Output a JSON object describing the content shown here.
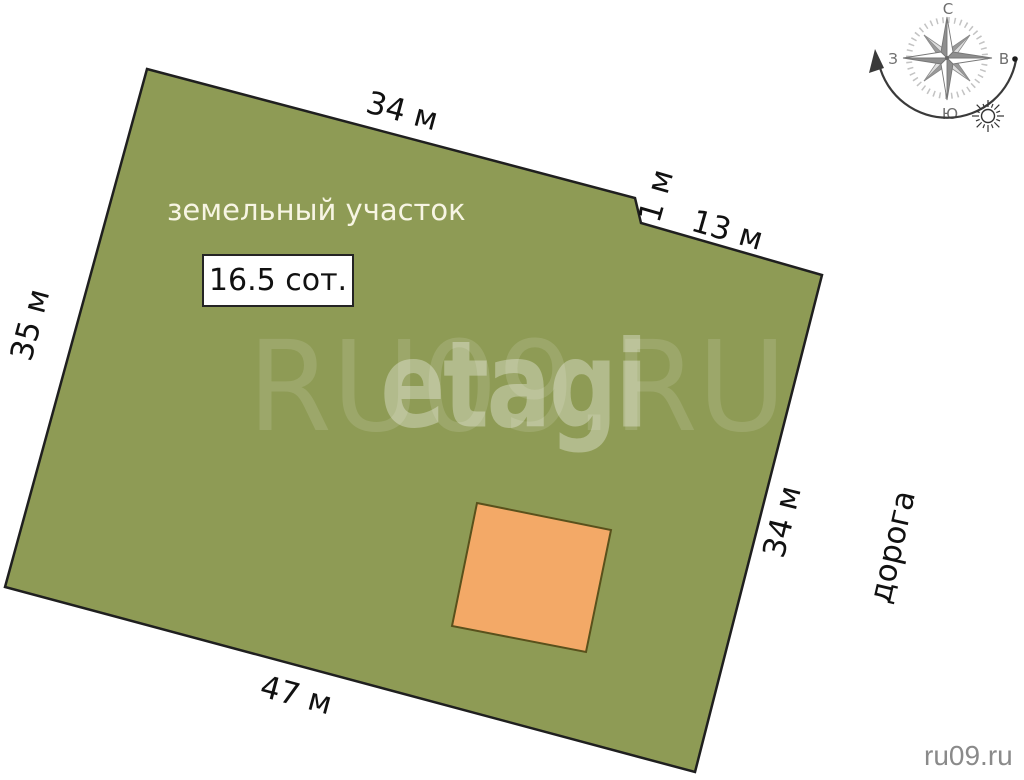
{
  "plot": {
    "name_label": "земельный участок",
    "area_label": "16.5 сот.",
    "dimensions": {
      "top": "34 м",
      "notch": "1 м",
      "top_right": "13 м",
      "left": "35 м",
      "right": "34 м",
      "bottom": "47 м"
    }
  },
  "road": {
    "label": "дорога"
  },
  "compass": {
    "north": "С",
    "east": "В",
    "south": "Ю",
    "west": "З"
  },
  "watermarks": {
    "large": "RU09.RU",
    "brand": "etagi",
    "site": "ru09.ru"
  },
  "colors": {
    "plot_fill": "#8e9b55",
    "plot_outline": "#1f1f1f",
    "building_fill": "#f3a967",
    "building_outline": "#59511c",
    "dimension_text": "#111111",
    "plot_name_text": "#f7f5e3",
    "area_text": "#111111",
    "area_box_bg": "#ffffff",
    "area_box_border": "#242424",
    "road_text": "#111111",
    "site_text": "#8a8a8a",
    "compass_stroke": "#8c8c8c",
    "arrow_stroke": "#3a3a3a",
    "watermark_tint": "#ffffff"
  }
}
